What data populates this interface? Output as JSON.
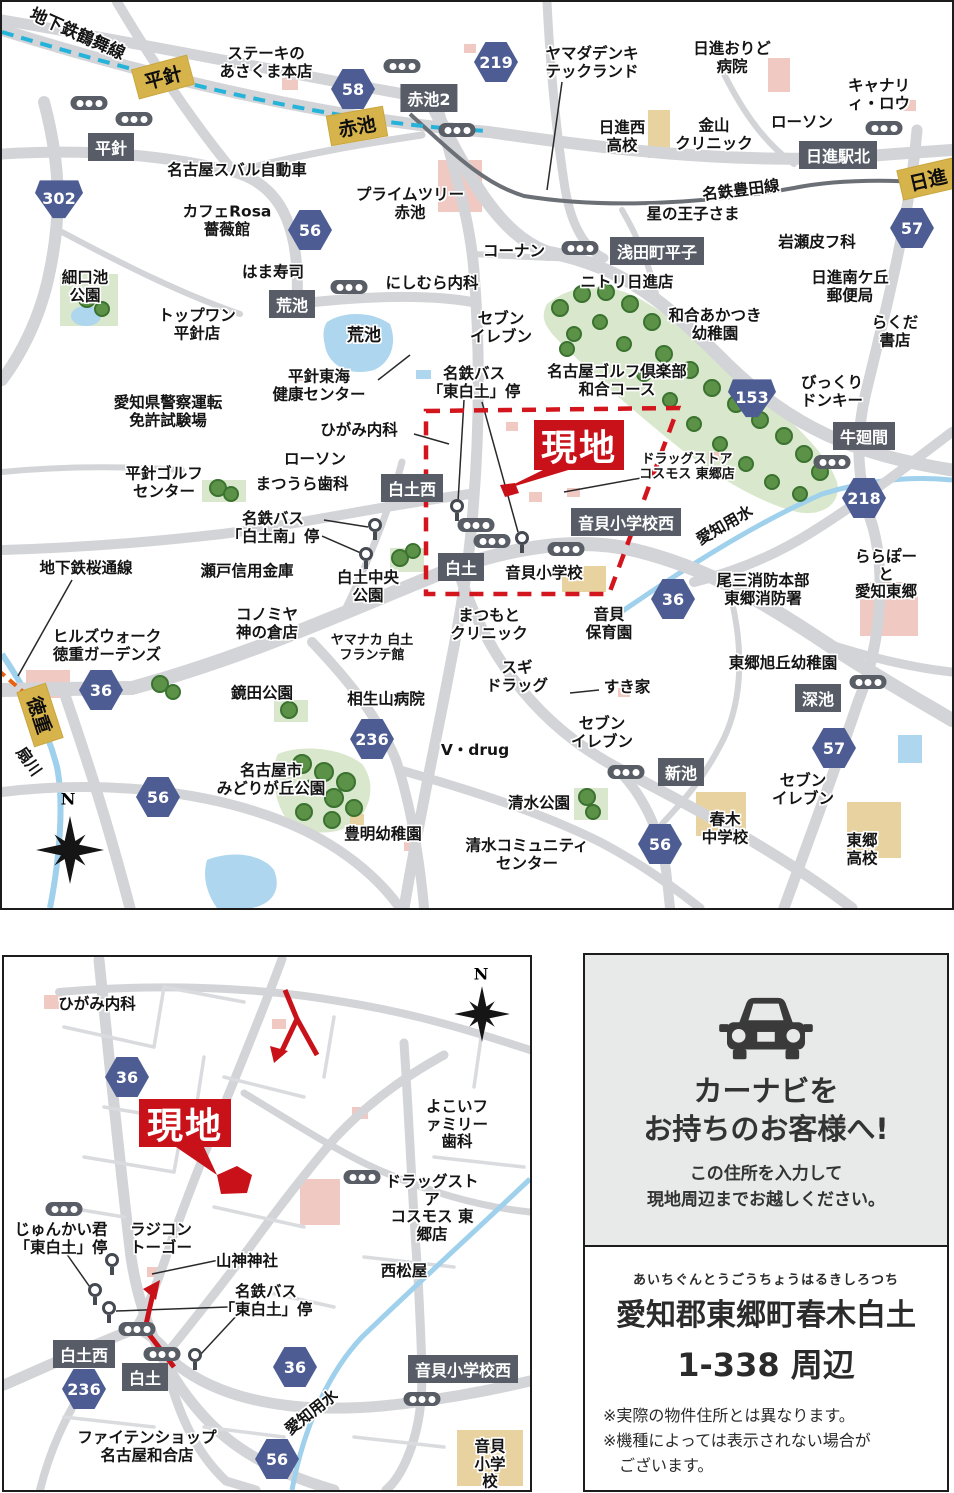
{
  "m1": {
    "lines": {
      "tsurumai": "地下鉄鶴舞線",
      "sakuradori": "地下鉄桜通線",
      "meitetsu": "名鉄豊田線"
    },
    "stations": [
      "平針",
      "赤池",
      "日進",
      "徳重"
    ],
    "intersections": [
      "平針",
      "赤池2",
      "荒池",
      "浅田町平子",
      "日進駅北",
      "牛廻間",
      "白土西",
      "白土",
      "音貝小学校西",
      "新池",
      "深池"
    ],
    "routes": [
      "302",
      "58",
      "219",
      "56",
      "57",
      "153",
      "218",
      "36",
      "36",
      "236",
      "56",
      "56",
      "57"
    ],
    "water": [
      "荒池",
      "愛知用水",
      "扇川"
    ],
    "site_label": "現地",
    "compass": "N",
    "places": [
      "ステーキの\nあさくま本店",
      "ヤマダデンキ\nテックランド",
      "日進おりど\n病院",
      "キャナリィ・ロウ",
      "日進西\n高校",
      "金山\nクリニック",
      "ローソン",
      "名古屋スバル自動車",
      "カフェRosa\n薔薇館",
      "プライムツリー\n赤池",
      "コーナン",
      "星の王子さま",
      "岩瀬皮フ科",
      "細口池\n公園",
      "はま寿司",
      "にしむら内科",
      "ニトリ日進店",
      "日進南ケ丘\n郵便局",
      "トップワン\n平針店",
      "和合あかつき\n幼稚園",
      "らくだ書店",
      "セブン\nイレブン",
      "平針東海\n健康センター",
      "名鉄バス\n「東白土」停",
      "名古屋ゴルフ倶楽部\n和合コース",
      "びっくり\nドンキー",
      "愛知県警察運転\n免許試験場",
      "ひがみ内科",
      "ローソン",
      "まつうら歯科",
      "平針ゴルフ\nセンター",
      "ドラッグストア\nコスモス 東郷店",
      "名鉄バス\n「白土南」停",
      "瀬戸信用金庫",
      "白土中央\n公園",
      "地下鉄桜通線",
      "尾三消防本部\n東郷消防署",
      "ららぽーと\n愛知東郷",
      "コノミヤ\n神の倉店",
      "音貝小学校",
      "まつもと\nクリニック",
      "音貝\n保育園",
      "ヒルズウォーク\n徳重ガーデンズ",
      "ヤマナカ 白土\nフランテ館",
      "スギ\nドラッグ",
      "東郷旭丘幼稚園",
      "鏡田公園",
      "相生山病院",
      "すき家",
      "セブン\nイレブン",
      "V・drug",
      "セブン\nイレブン",
      "名古屋市\nみどりが丘公園",
      "清水公園",
      "春木\n中学校",
      "東郷\n高校",
      "豊明幼稚園",
      "清水コミュニティ\nセンター"
    ]
  },
  "m2": {
    "intersections": [
      "白土西",
      "白土",
      "音貝小学校西"
    ],
    "routes": [
      "36",
      "236",
      "56",
      "36"
    ],
    "water": "愛知用水",
    "site_label": "現地",
    "compass": "N",
    "places": [
      "ひがみ内科",
      "よこいファミリー\n歯科",
      "ドラッグストア\nコスモス 東郷店",
      "西松屋",
      "じゅんかい君\n「東白土」停",
      "ラジコン\nトーゴー",
      "山神神社",
      "名鉄バス\n「東白土」停",
      "ファイテンショップ\n名古屋和合店",
      "音貝\n小学校"
    ]
  },
  "panel": {
    "title1": "カーナビを",
    "title2": "お持ちのお客様へ!",
    "sub": "この住所を入力して\n現地周辺までお越しください。",
    "furigana": "あいちぐんとうごうちょうはるきしろつち",
    "address": "愛知郡東郷町春木白土",
    "address2": "1-338 周辺",
    "notes": "※実際の物件住所とは異なります。\n※機種によっては表示されない場合が\n　ございます。"
  }
}
